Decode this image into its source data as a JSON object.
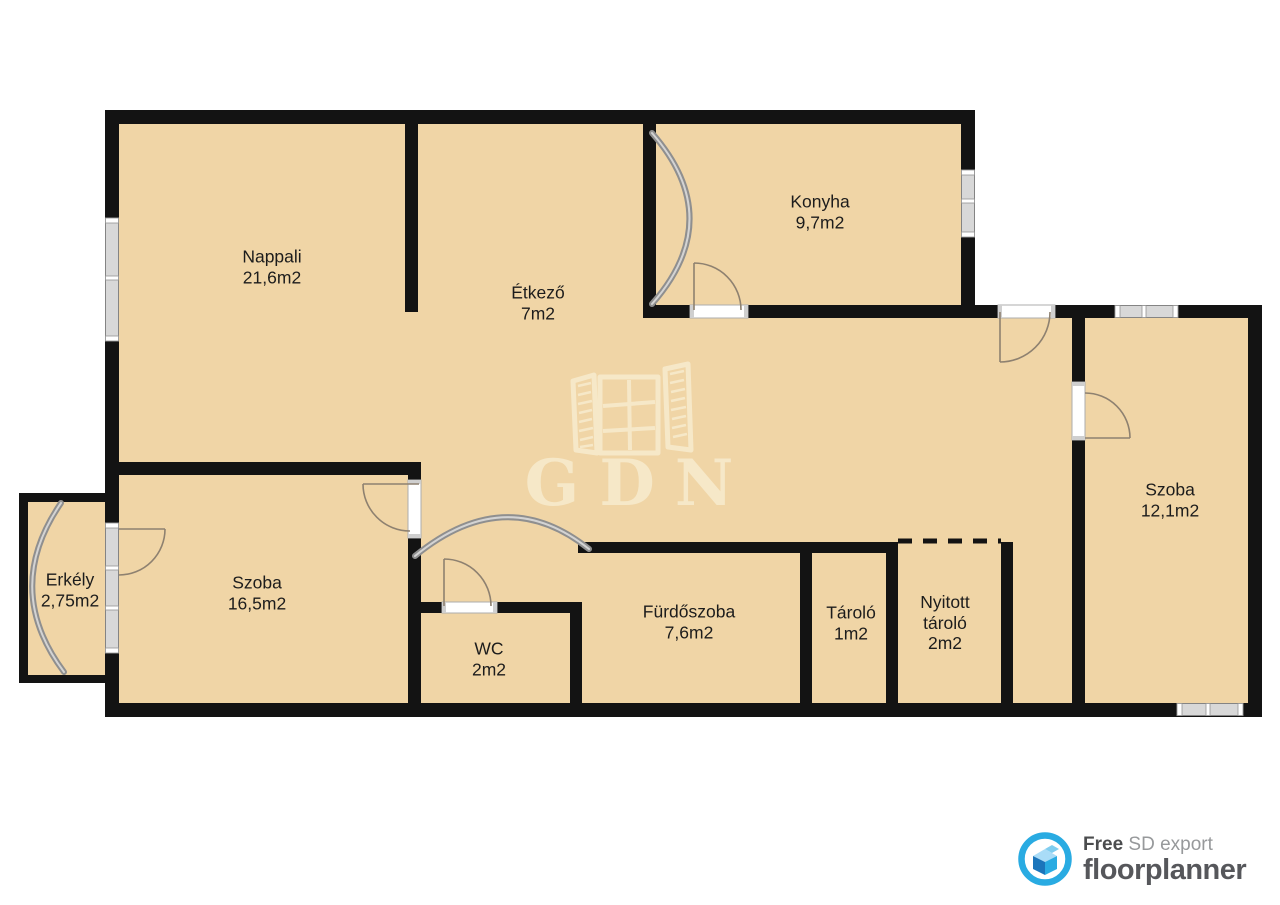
{
  "plan": {
    "watermark": "GDN",
    "rooms": [
      {
        "name": "Nappali",
        "area": "21,6m2"
      },
      {
        "name": "Étkező",
        "area": "7m2"
      },
      {
        "name": "Konyha",
        "area": "9,7m2"
      },
      {
        "name": "Szoba",
        "area": "12,1m2"
      },
      {
        "name": "Erkély",
        "area": "2,75m2"
      },
      {
        "name": "Szoba",
        "area": "16,5m2"
      },
      {
        "name": "WC",
        "area": "2m2"
      },
      {
        "name": "Fürdőszoba",
        "area": "7,6m2"
      },
      {
        "name": "Tároló",
        "area": "1m2"
      },
      {
        "name": "Nyitott tároló",
        "area": "2m2"
      }
    ],
    "colors": {
      "floor": "#F0D5A6",
      "wall": "#131313",
      "window_band": "#D8D8D8",
      "door_line": "#8E8170",
      "watermark": "#F6E8C8",
      "label_text": "#1C1C1C",
      "brand_blue": "#29ABE2",
      "brand_blue_dark": "#1B75BB",
      "brand_blue_light": "#A9DCF7",
      "footer_dark": "#4B4C4E",
      "footer_muted": "#97999B",
      "footer_brand": "#56575B"
    }
  },
  "footer": {
    "free": "Free",
    "sd_export": "SD export",
    "brand": "floorplanner"
  }
}
